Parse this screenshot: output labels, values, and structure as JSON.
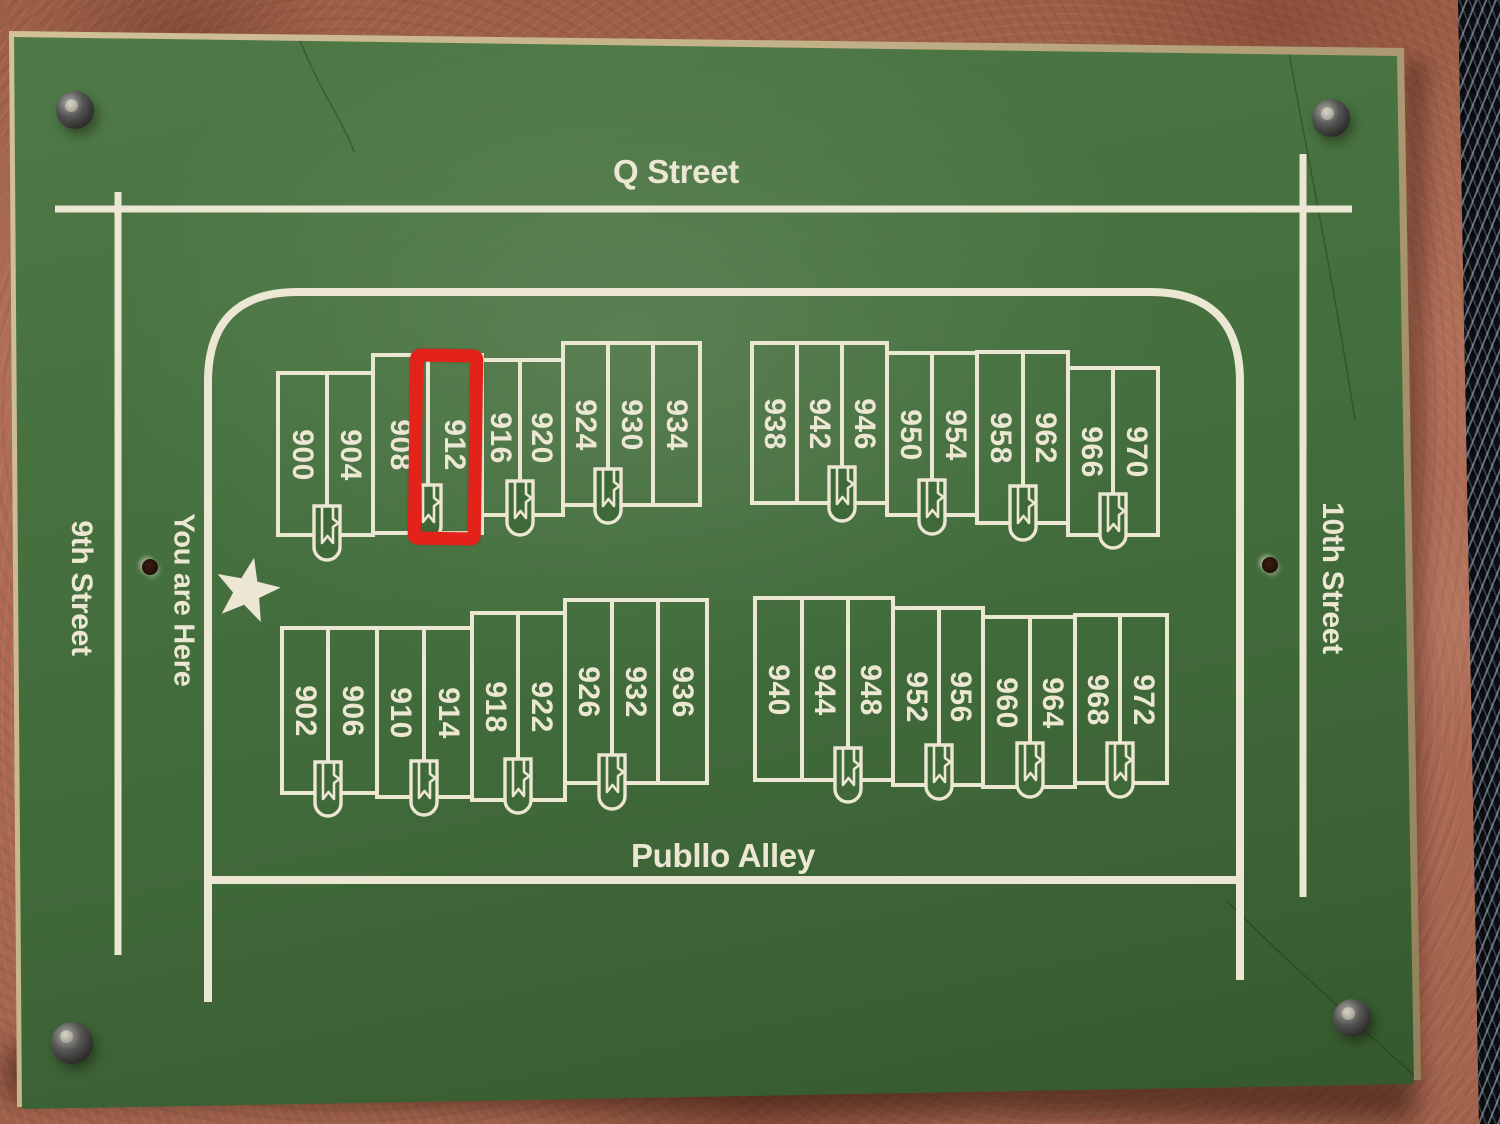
{
  "streets": {
    "top": "Q Street",
    "left": "9th Street",
    "right": "10th Street",
    "bottom": "Publlo Alley"
  },
  "marker": {
    "you_are_here": "You are Here"
  },
  "annotation": {
    "highlighted_unit": "912"
  },
  "blocks": {
    "nw": [
      [
        "900",
        "904"
      ],
      [
        "908",
        "912"
      ],
      [
        "916",
        "920"
      ],
      [
        "924",
        "930",
        "934"
      ]
    ],
    "ne": [
      [
        "938",
        "942",
        "946"
      ],
      [
        "950",
        "954"
      ],
      [
        "958",
        "962"
      ],
      [
        "966",
        "970"
      ]
    ],
    "sw": [
      [
        "902",
        "906"
      ],
      [
        "910",
        "914"
      ],
      [
        "918",
        "922"
      ],
      [
        "926",
        "932",
        "936"
      ]
    ],
    "se": [
      [
        "940",
        "944",
        "948"
      ],
      [
        "952",
        "956"
      ],
      [
        "960",
        "964"
      ],
      [
        "968",
        "972"
      ]
    ]
  },
  "colors": {
    "sign_green": "#44703e",
    "paint_cream": "#ece7d3",
    "highlight_red": "#e3231a",
    "wall_stucco": "#a6654e",
    "mesh_dark": "#0b0e13"
  }
}
